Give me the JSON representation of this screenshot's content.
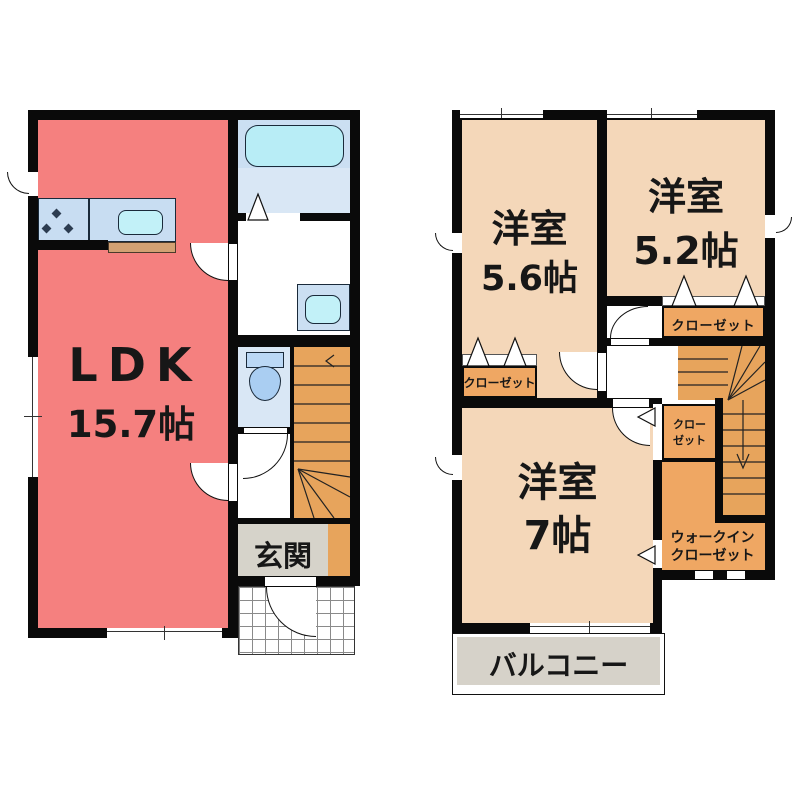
{
  "document_type": "floor-plan",
  "floor1": {
    "ldk": {
      "name": "LDK",
      "size": "15.7帖"
    },
    "entrance": {
      "label": "玄関"
    }
  },
  "floor2": {
    "rooms": [
      {
        "name": "洋室",
        "size": "5.6帖"
      },
      {
        "name": "洋室",
        "size": "5.2帖"
      },
      {
        "name": "洋室",
        "size": "7帖"
      }
    ],
    "closet_52": "クローゼット",
    "closet_56": "クローゼット",
    "closet_stair": {
      "line1": "クロー",
      "line2": "ゼット"
    },
    "walk_in_closet": {
      "line1": "ウォークイン",
      "line2": "クローゼット"
    },
    "balcony": "バルコニー"
  },
  "colors": {
    "ldk_floor": "#F5807F",
    "western_room_floor": "#F4D7B9",
    "closet_fill": "#EFA763",
    "stairs_fill": "#E7A45C",
    "entrance_floor": "#D6D3CA",
    "balcony_floor": "#D6D2C9",
    "bath_floor": "#D9E7F5",
    "bathtub": "#B8EDF6",
    "counter": "#C8DDF2",
    "sink": "#C2F1F8",
    "toilet": "#AACEF2",
    "counter_base": "#D2A173",
    "wall": "#0A0A0A"
  }
}
